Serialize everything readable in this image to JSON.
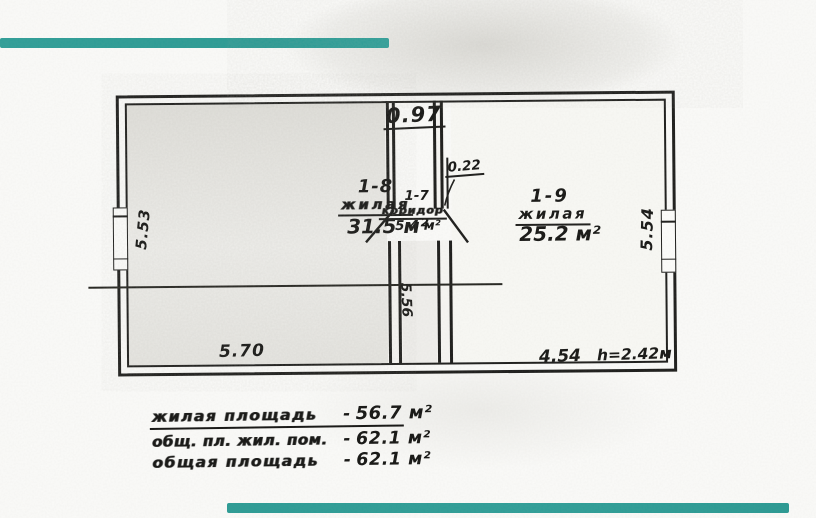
{
  "rooms": [
    {
      "number": "1-8",
      "name": "жилая",
      "area": "31.5 м²"
    },
    {
      "number": "1-7",
      "name": "коридор",
      "area": "5.4 м²"
    },
    {
      "number": "1-9",
      "name": "жилая",
      "area": "25.2 м²"
    }
  ],
  "dimensions": {
    "corridor_top_width": "0.97",
    "wall_offset": "0.22",
    "left_side": "5.53",
    "right_side": "5.54",
    "corridor_length": "5.56",
    "bottom_left": "5.70",
    "bottom_right": "4.54",
    "ceiling_height": "h=2.42м"
  },
  "summary": {
    "separator": "-",
    "rows": [
      {
        "label": "жилая площадь",
        "value": "56.7 м²"
      },
      {
        "label": "общ. пл. жил. пом.",
        "value": "62.1 м²"
      },
      {
        "label": "общая площадь",
        "value": "62.1 м²"
      }
    ]
  },
  "colors": {
    "ink": "#1c1c1a",
    "scan_bar_teal": "#2c9c95",
    "room_shade": "#e9e7e0",
    "paper": "#fbfbf9"
  }
}
